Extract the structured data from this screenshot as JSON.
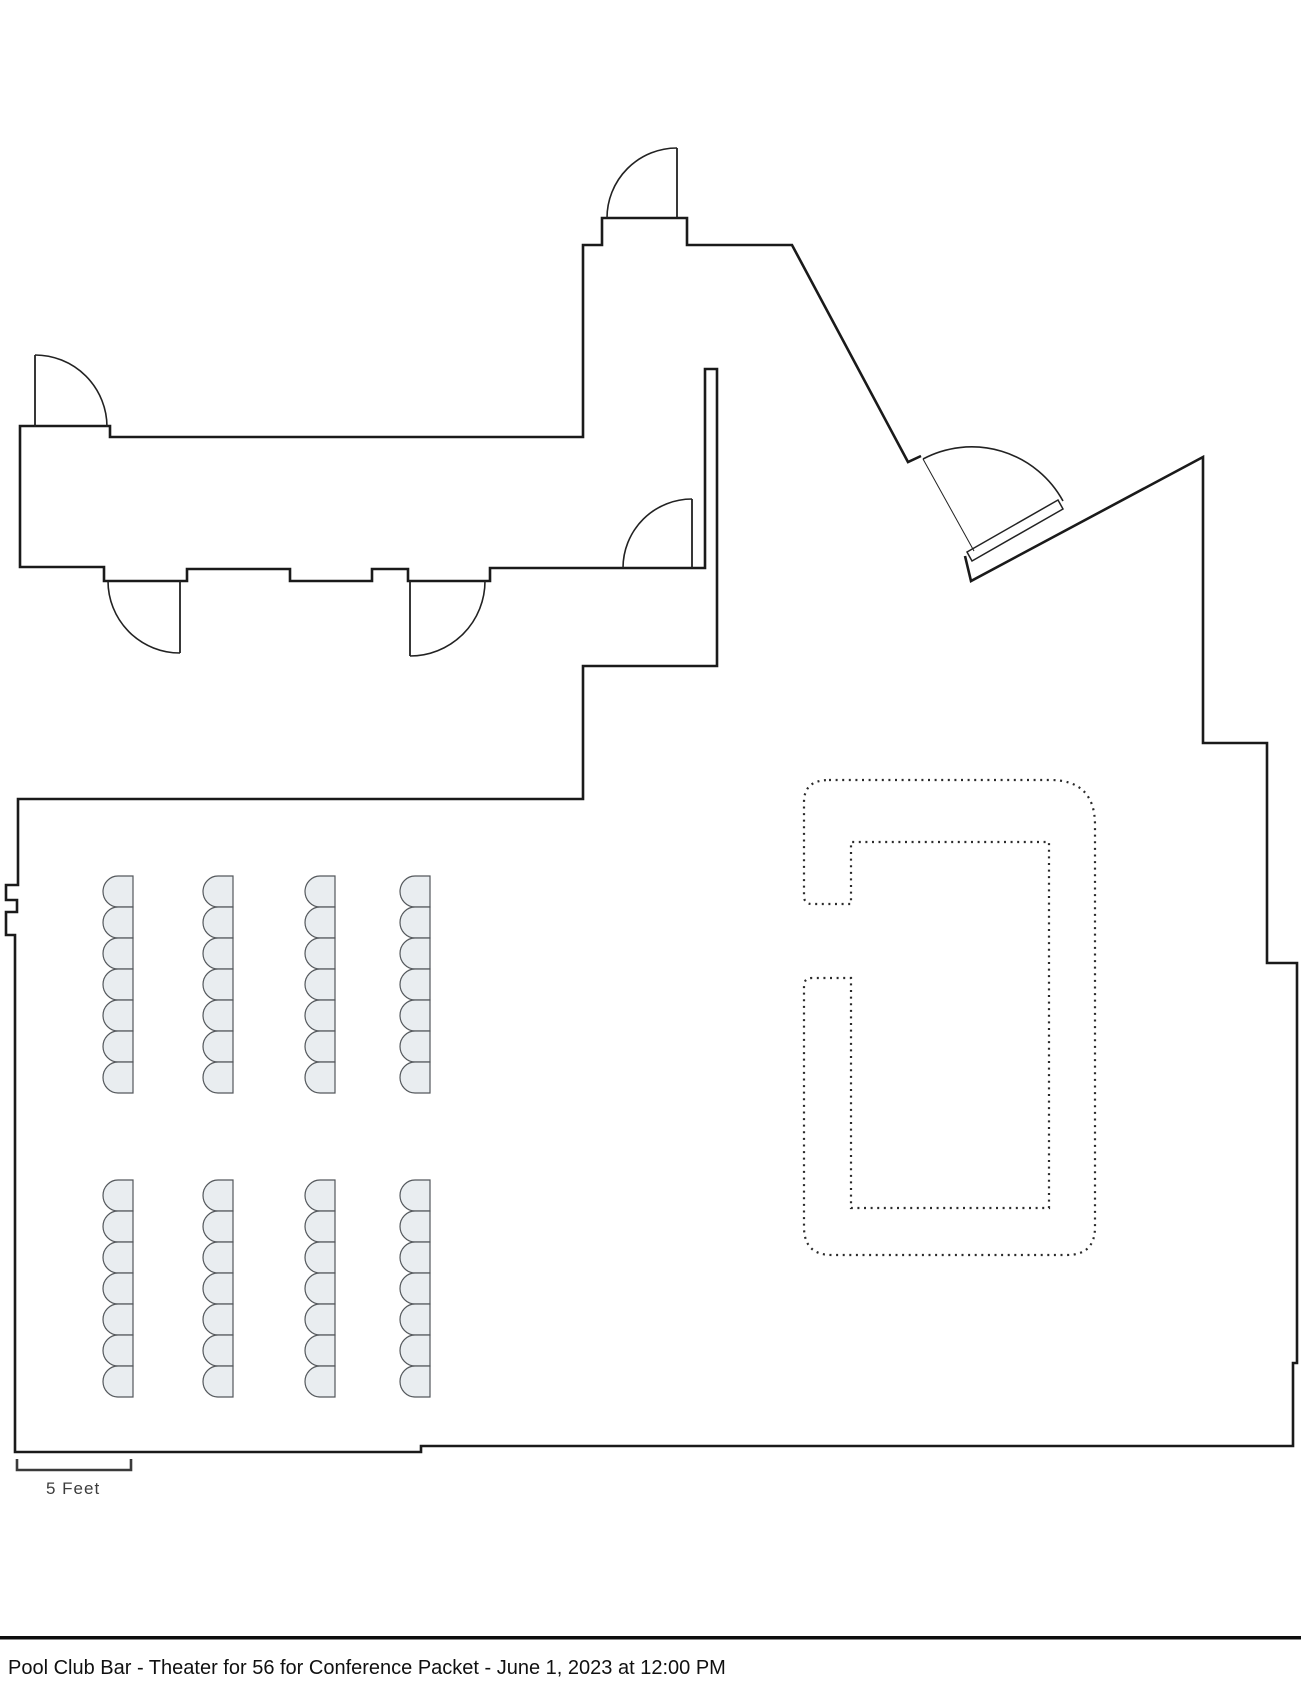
{
  "document": {
    "kind": "event floor plan",
    "footer": {
      "title": "Pool Club Bar - Theater for 56 for Conference Packet - June 1, 2023 at 12:00 PM"
    },
    "scale_bar": {
      "label": "5 Feet"
    }
  },
  "colors": {
    "wall": "#1a1a1a",
    "door": "#222222",
    "dotted_bar_outline": "#2b2b2b",
    "chair_fill": "#e9edf0",
    "chair_stroke": "#54585c",
    "background": "#ffffff"
  },
  "seating": {
    "total_seats": 56,
    "arrangement": "theater",
    "chair": {
      "width": 30,
      "height": 31
    },
    "blocks": [
      {
        "name": "front-block",
        "rows_y_start": 876,
        "row_pitch": 31,
        "chairs_per_column": 7,
        "columns_x": [
          103,
          203,
          305,
          400
        ]
      },
      {
        "name": "back-block",
        "rows_y_start": 1180,
        "row_pitch": 31,
        "chairs_per_column": 7,
        "columns_x": [
          103,
          203,
          305,
          400
        ]
      }
    ]
  }
}
